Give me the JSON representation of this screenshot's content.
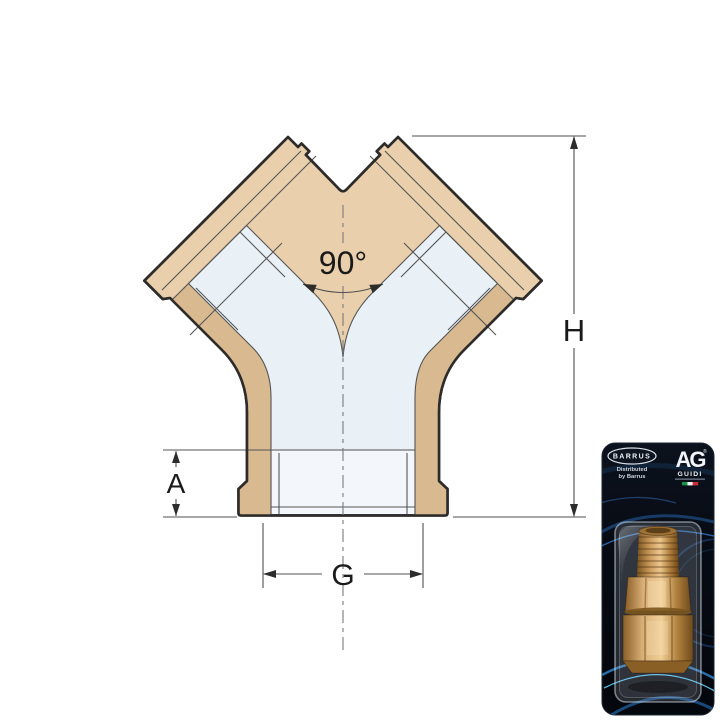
{
  "diagram": {
    "angle_label": "90°",
    "height_label": "H",
    "socket_depth_label": "A",
    "thread_label": "G",
    "colors": {
      "body": "#e9cfac",
      "wall_shade": "#d8b990",
      "bore": "#e9f1f7",
      "outline": "#2e2c2a",
      "thin_line": "#555555",
      "dim_line": "#4f4f4f",
      "label": "#1a1a1a",
      "background": "#ffffff"
    }
  },
  "packaging": {
    "brand": "BARRUS",
    "distributed_line1": "Distributed",
    "distributed_line2": "by Barrus",
    "logo": "AG",
    "logo_registered": "®",
    "logo_sub": "GUIDI",
    "flag_colors": {
      "green": "#159447",
      "white": "#f2f4f6",
      "red": "#cf2b37"
    },
    "card_colors": {
      "background": "#0a0f18",
      "glow_blue": "#2f83c9",
      "glow_cyan": "#58c4ee"
    },
    "product_icon": "brass-union-fitting"
  }
}
